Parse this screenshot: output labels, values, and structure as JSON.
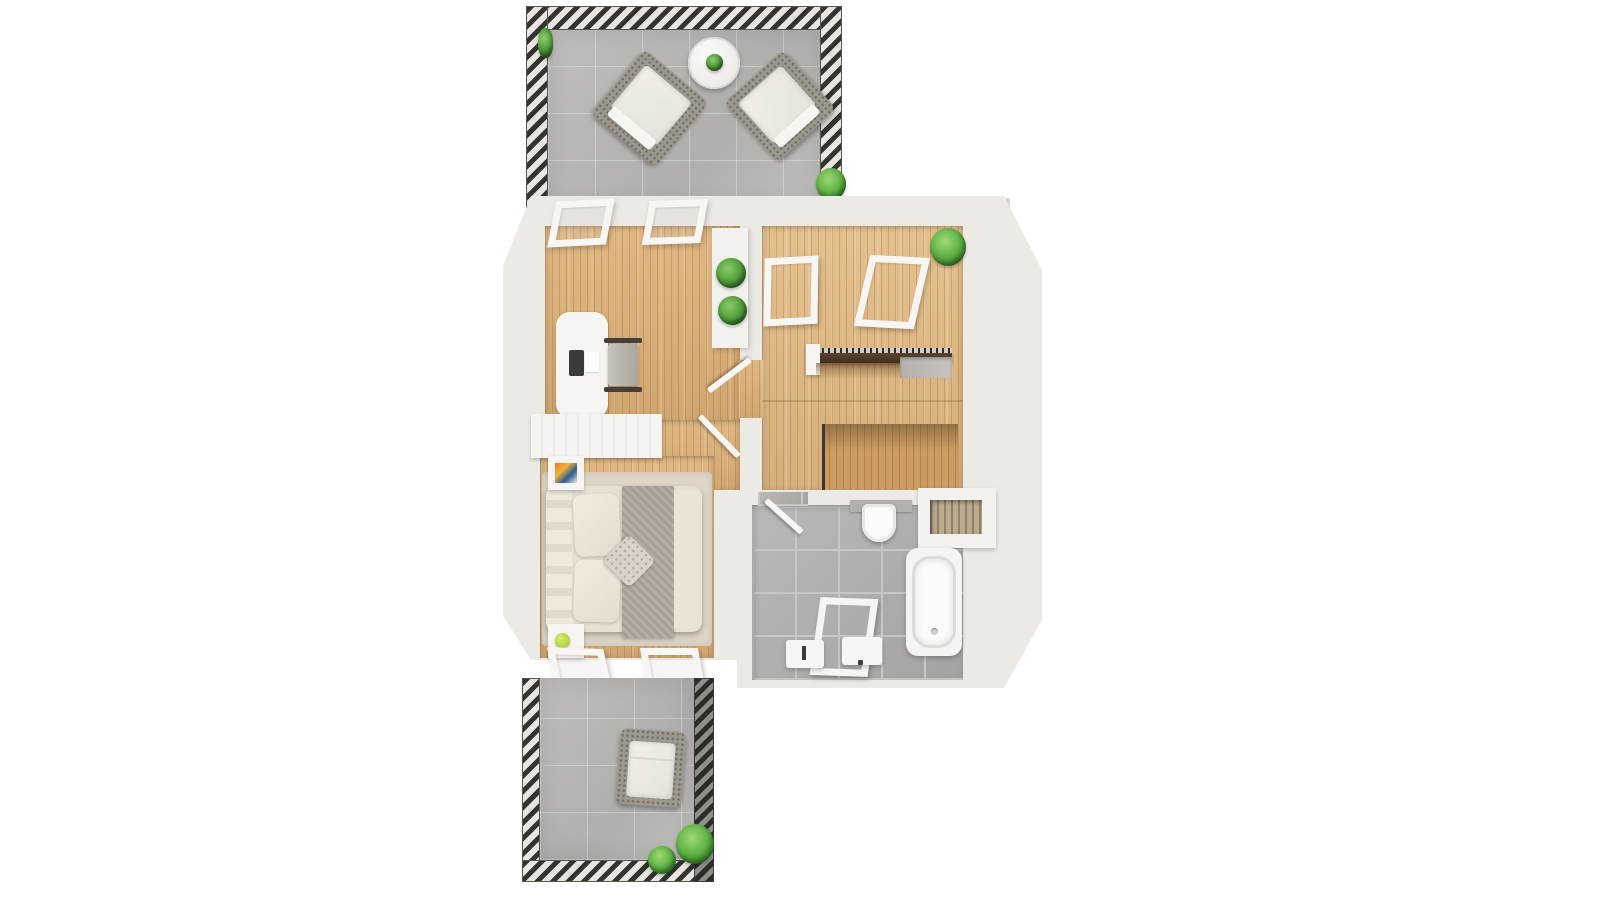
{
  "scene": {
    "description": "3D top-down architectural floor plan render of an attic floor with two stone-tiled terraces, an office, a stair room, a bedroom and a bathroom",
    "background_color": "#ffffff"
  },
  "palette": {
    "wall": "#eceae5",
    "wall_bright": "#f6f5f2",
    "wood_floor": "#ddb077",
    "wood_floor_light": "#e2ba83",
    "stairwell_wood": "#cf9f63",
    "terrace_tile": "#b9b8b5",
    "bathroom_tile": "#b2b0ac",
    "railing_hatch_dark": "#35342f",
    "stair_handrail_wood": "#4e3a27",
    "plant_green": "#57a33d",
    "wicker": "#9d988e",
    "cushion": "#edebe4",
    "bed_linen": "#e7e1d3",
    "blanket_gray": "#a79e94",
    "nightstand_art": [
      "#e8762a",
      "#2a5d8f",
      "#f0e8e0"
    ],
    "nightstand_lamp_green": "#b5d437"
  },
  "areas": {
    "top_terrace": {
      "name": "top-terrace",
      "floor": "stone-tiles",
      "objects": [
        "railing-top",
        "railing-left",
        "railing-right",
        "round-side-table",
        "table-plant",
        "lounge-chair-left",
        "lounge-chair-right",
        "corner-plant",
        "edge-plant"
      ]
    },
    "office": {
      "name": "office",
      "floor": "wood-planks",
      "objects": [
        "roof-window-left",
        "roof-window-right",
        "desk",
        "desk-tablet",
        "desk-paper",
        "office-chair",
        "console-shelf",
        "console-plant-upper",
        "console-plant-lower"
      ]
    },
    "stair_room": {
      "name": "stair-room",
      "floor": "wood-planks",
      "objects": [
        "floor-window-left",
        "floor-window-right",
        "corner-plant",
        "stair-handrail",
        "handrail-post",
        "stair-landing",
        "stairwell-opening"
      ]
    },
    "hallway": {
      "name": "hallway",
      "floor": "wood-planks",
      "objects": [
        "door-to-stair-room",
        "door-to-bedroom"
      ]
    },
    "bedroom": {
      "name": "bedroom",
      "floor": "wood-planks",
      "objects": [
        "wardrobe",
        "rug",
        "double-bed",
        "headboard",
        "pillow-top",
        "pillow-bottom",
        "accent-pillow",
        "runner-blanket",
        "duvet",
        "nightstand-top",
        "nightstand-art",
        "nightstand-bottom",
        "nightstand-lamp",
        "floor-window-left",
        "floor-window-right"
      ]
    },
    "bathroom": {
      "name": "bathroom",
      "floor": "gray-tiles",
      "objects": [
        "door",
        "toilet",
        "wall-niche",
        "bathtub",
        "shower-frame",
        "sink-left",
        "sink-right"
      ]
    },
    "bottom_terrace": {
      "name": "bottom-terrace",
      "floor": "stone-tiles",
      "objects": [
        "railing-left",
        "railing-bottom",
        "railing-right",
        "lounge-chair",
        "plant-large",
        "plant-small"
      ]
    }
  }
}
